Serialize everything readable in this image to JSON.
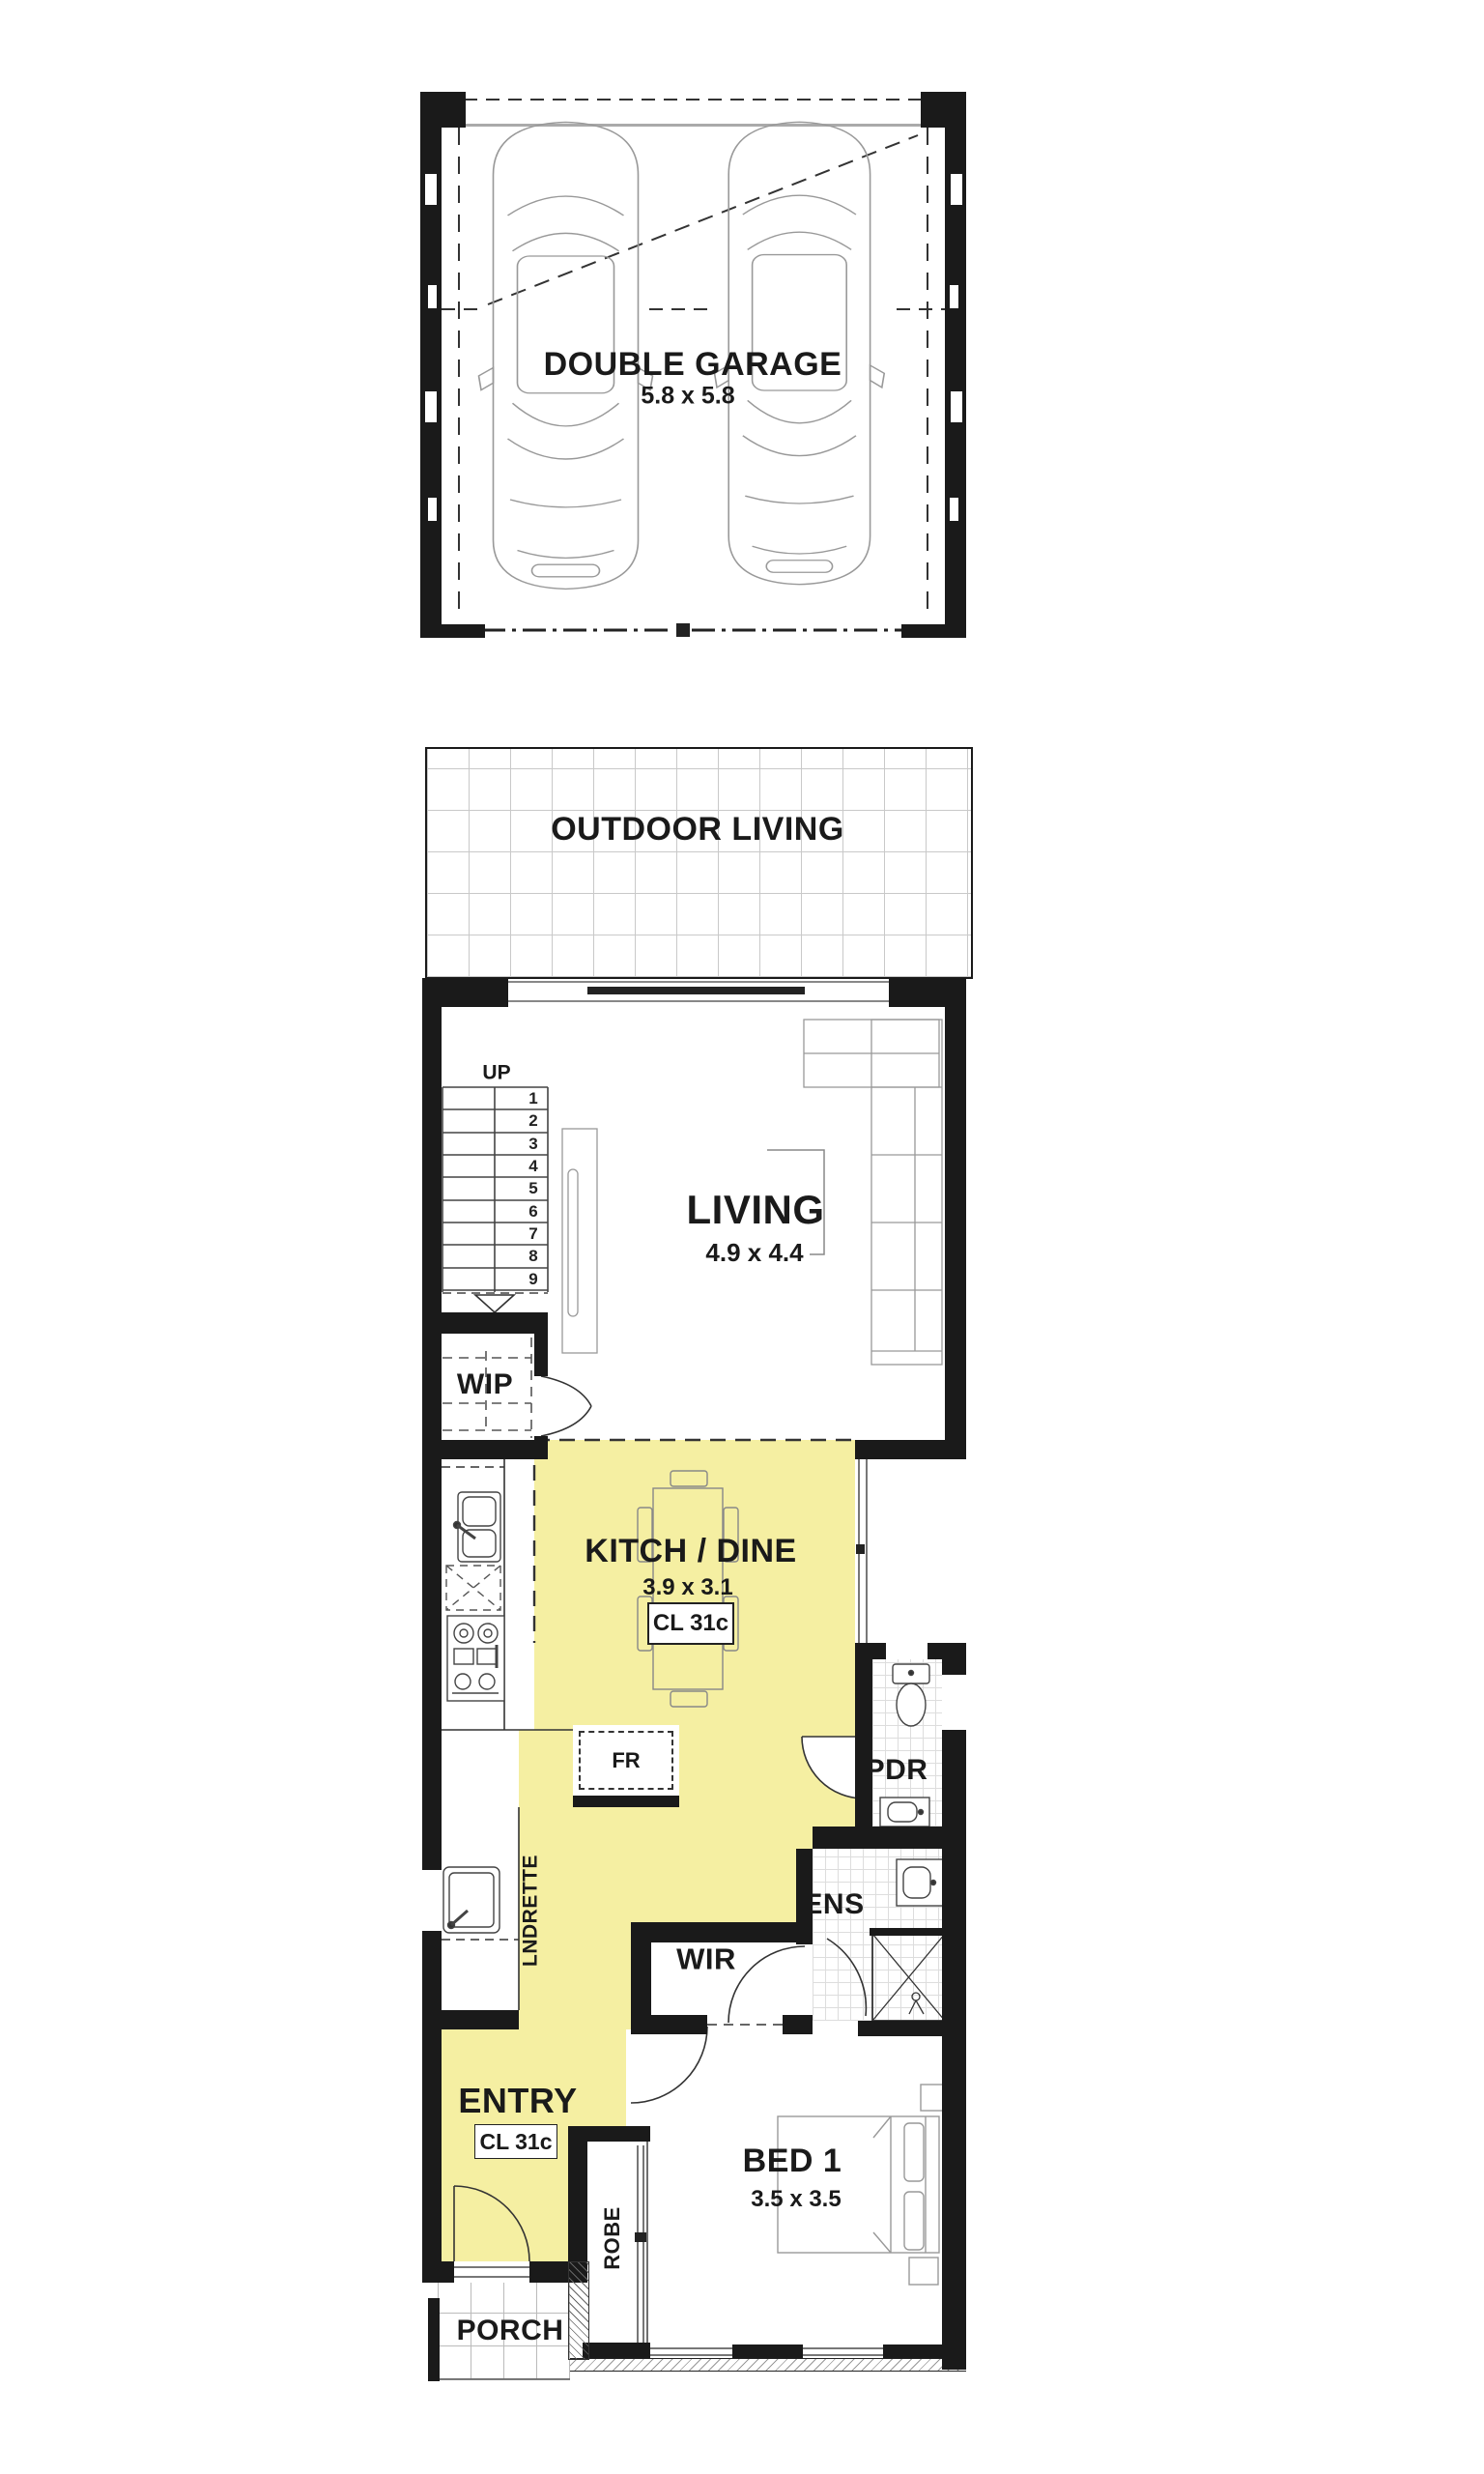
{
  "colors": {
    "highlight": "#f5efa2",
    "wall": "#1a1a1a"
  },
  "rooms": {
    "garage": {
      "label": "DOUBLE GARAGE",
      "dims": "5.8 x 5.8"
    },
    "outdoor": {
      "label": "OUTDOOR LIVING"
    },
    "living": {
      "label": "LIVING",
      "dims": "4.9 x 4.4"
    },
    "stairs": {
      "up": "UP",
      "steps": [
        "1",
        "2",
        "3",
        "4",
        "5",
        "6",
        "7",
        "8",
        "9"
      ]
    },
    "wip": {
      "label": "WIP"
    },
    "kitch": {
      "label": "KITCH / DINE",
      "dims": "3.9 x 3.1",
      "ceiling": "CL 31c"
    },
    "fridge": {
      "label": "FR"
    },
    "pdr": {
      "label": "PDR"
    },
    "lndrette": {
      "label": "LNDRETTE"
    },
    "ens": {
      "label": "ENS"
    },
    "wir": {
      "label": "WIR"
    },
    "entry": {
      "label": "ENTRY",
      "ceiling": "CL 31c"
    },
    "bed1": {
      "label": "BED 1",
      "dims": "3.5 x 3.5"
    },
    "robe": {
      "label": "ROBE"
    },
    "porch": {
      "label": "PORCH"
    }
  }
}
